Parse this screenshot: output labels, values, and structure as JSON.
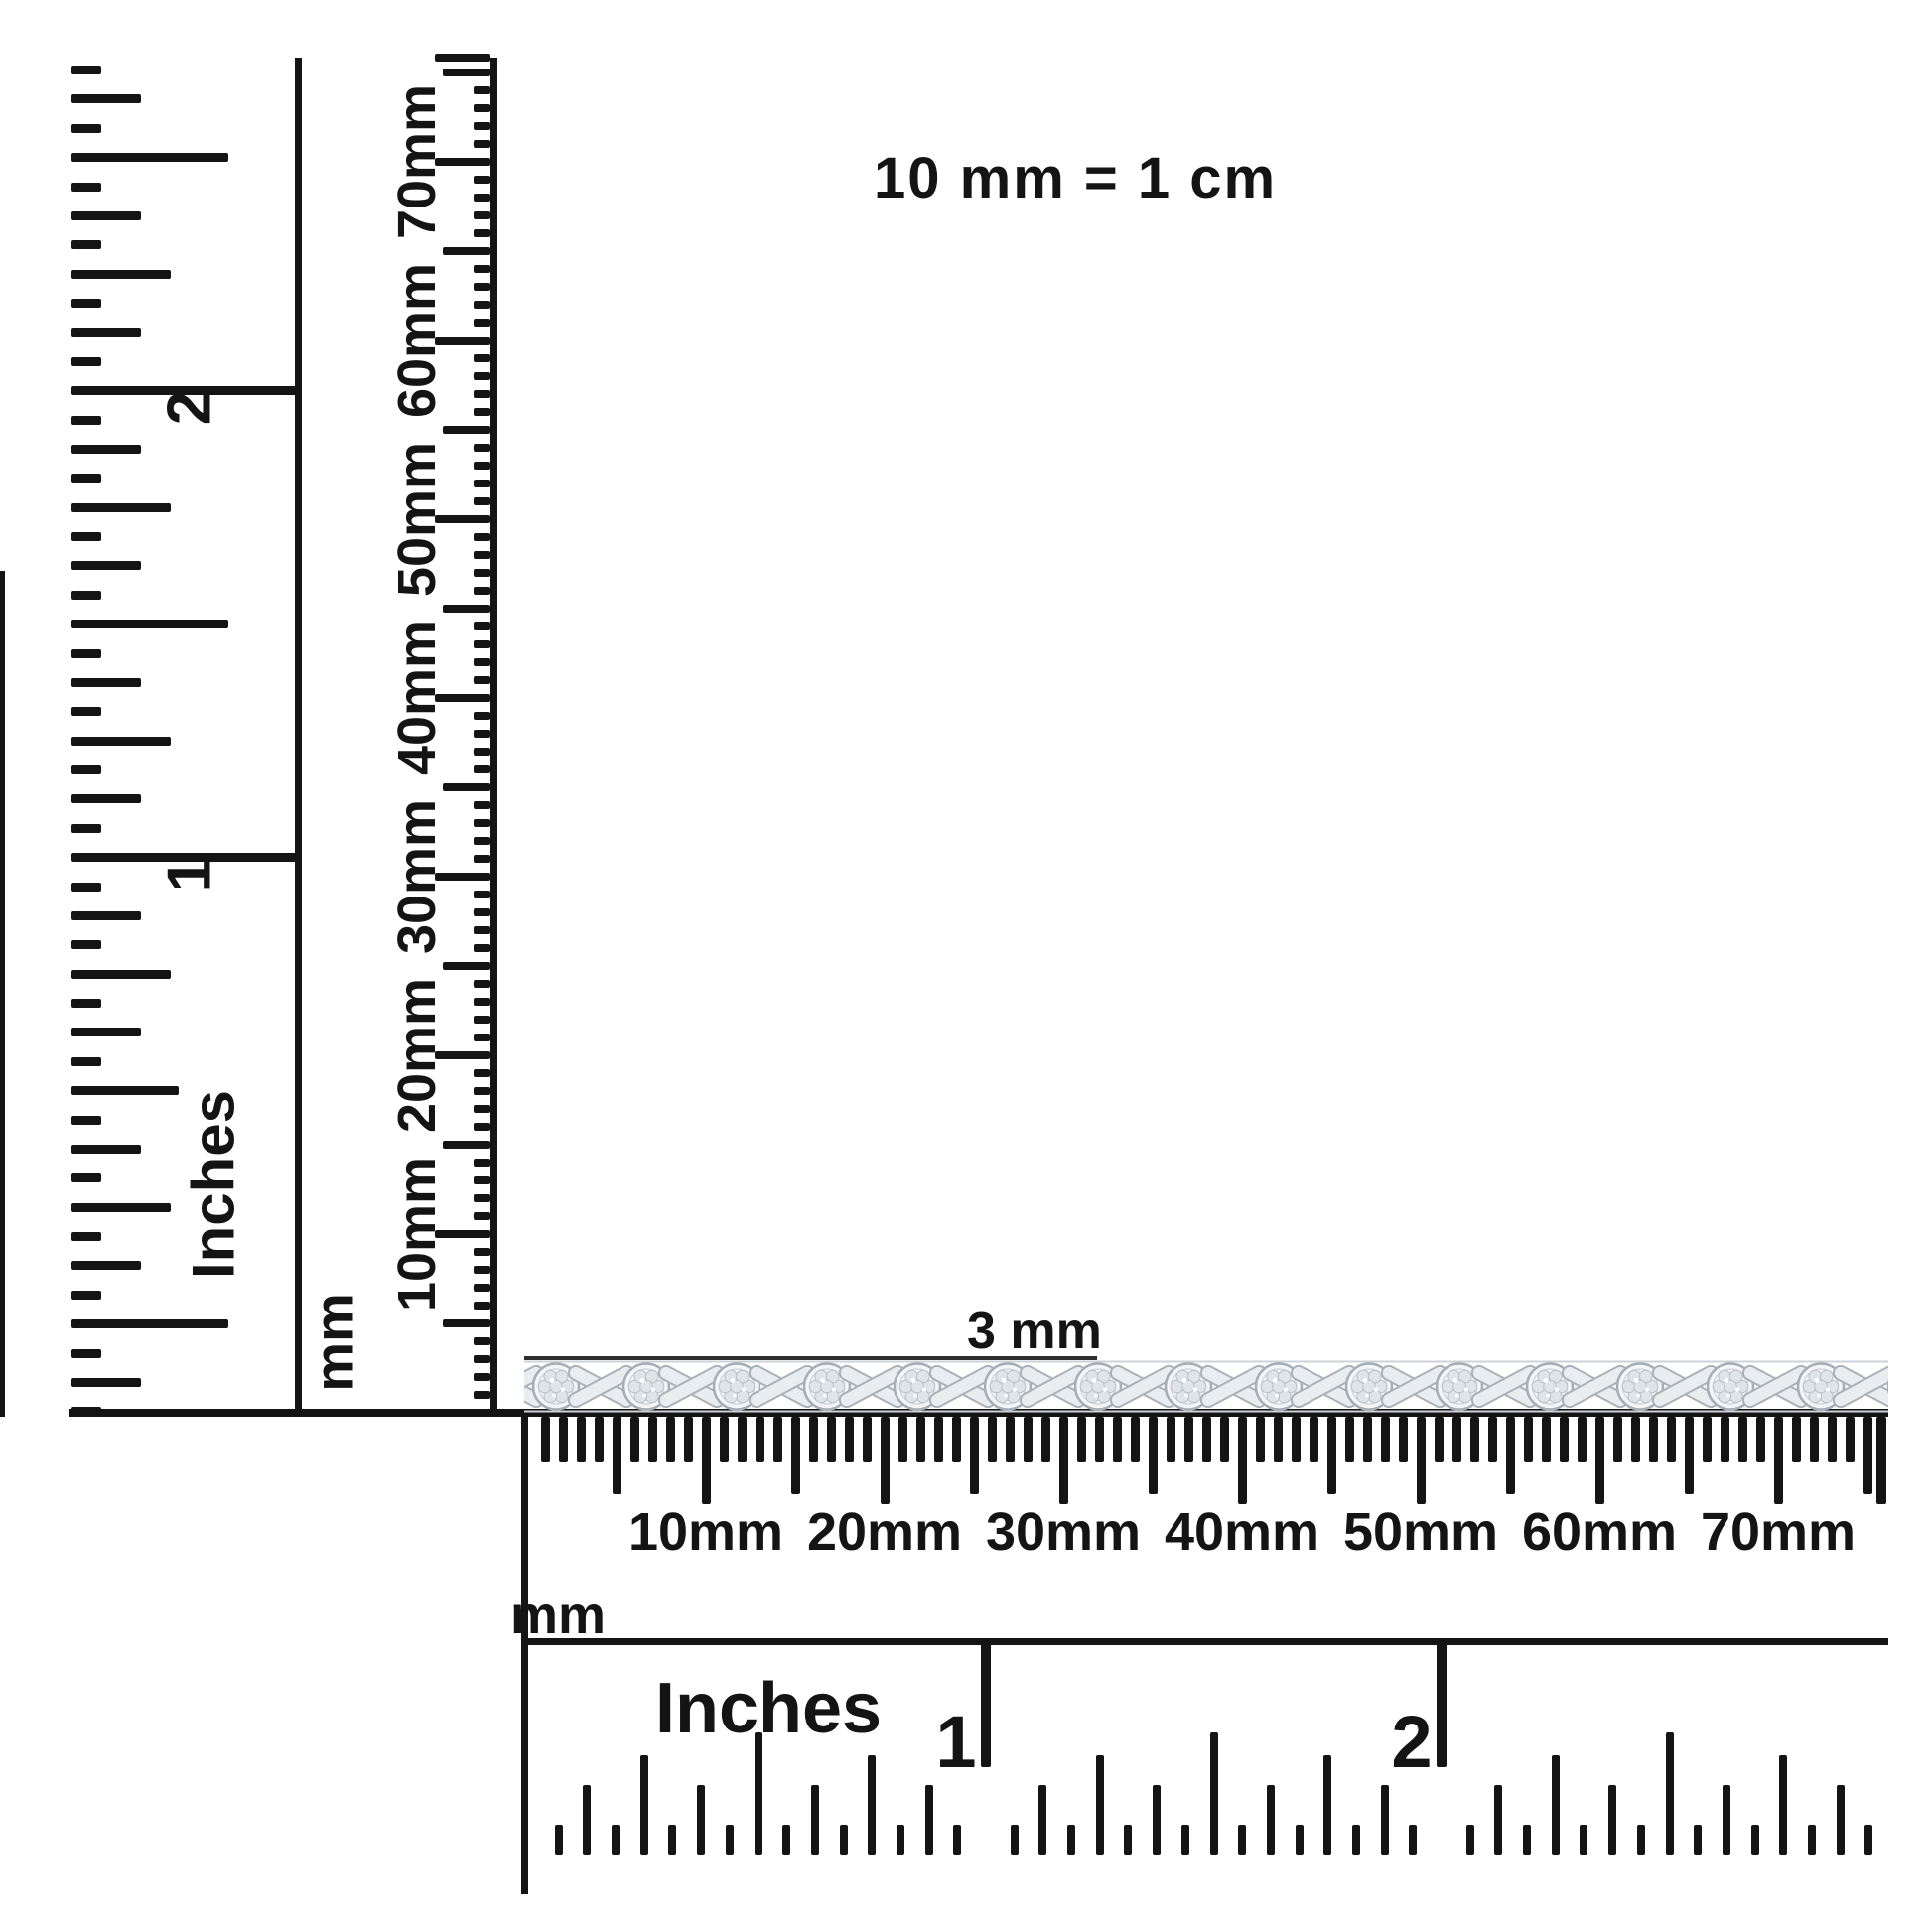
{
  "title": "10 mm = 1 cm",
  "annotation": {
    "label": "3 mm"
  },
  "vertical_inch_ruler": {
    "unit_label": "Inches",
    "inch_numbers": [
      "1",
      "2"
    ]
  },
  "vertical_mm_ruler": {
    "unit_label": "mm",
    "tick_labels": [
      "10mm",
      "20mm",
      "30mm",
      "40mm",
      "50mm",
      "60mm",
      "70mm"
    ]
  },
  "horizontal_mm_ruler": {
    "unit_label": "mm",
    "tick_labels": [
      "10mm",
      "20mm",
      "30mm",
      "40mm",
      "50mm",
      "60mm",
      "70mm"
    ]
  },
  "horizontal_inch_ruler": {
    "unit_label": "Inches",
    "inch_numbers": [
      "1",
      "2"
    ]
  },
  "bracelet": {
    "description": "silver XO-link bracelet with round pave diamond clusters",
    "cluster_count": 15,
    "colors": {
      "outline": "#a6adb4",
      "fill": "#f3f5f7",
      "petal": "#dfe4e8",
      "petal_outline": "#b9c0c6",
      "ribbon": "#eaedf0",
      "ribbon_outline": "#aab1b7",
      "sparkle": "#ffffff"
    }
  },
  "ink_color": "#141414"
}
